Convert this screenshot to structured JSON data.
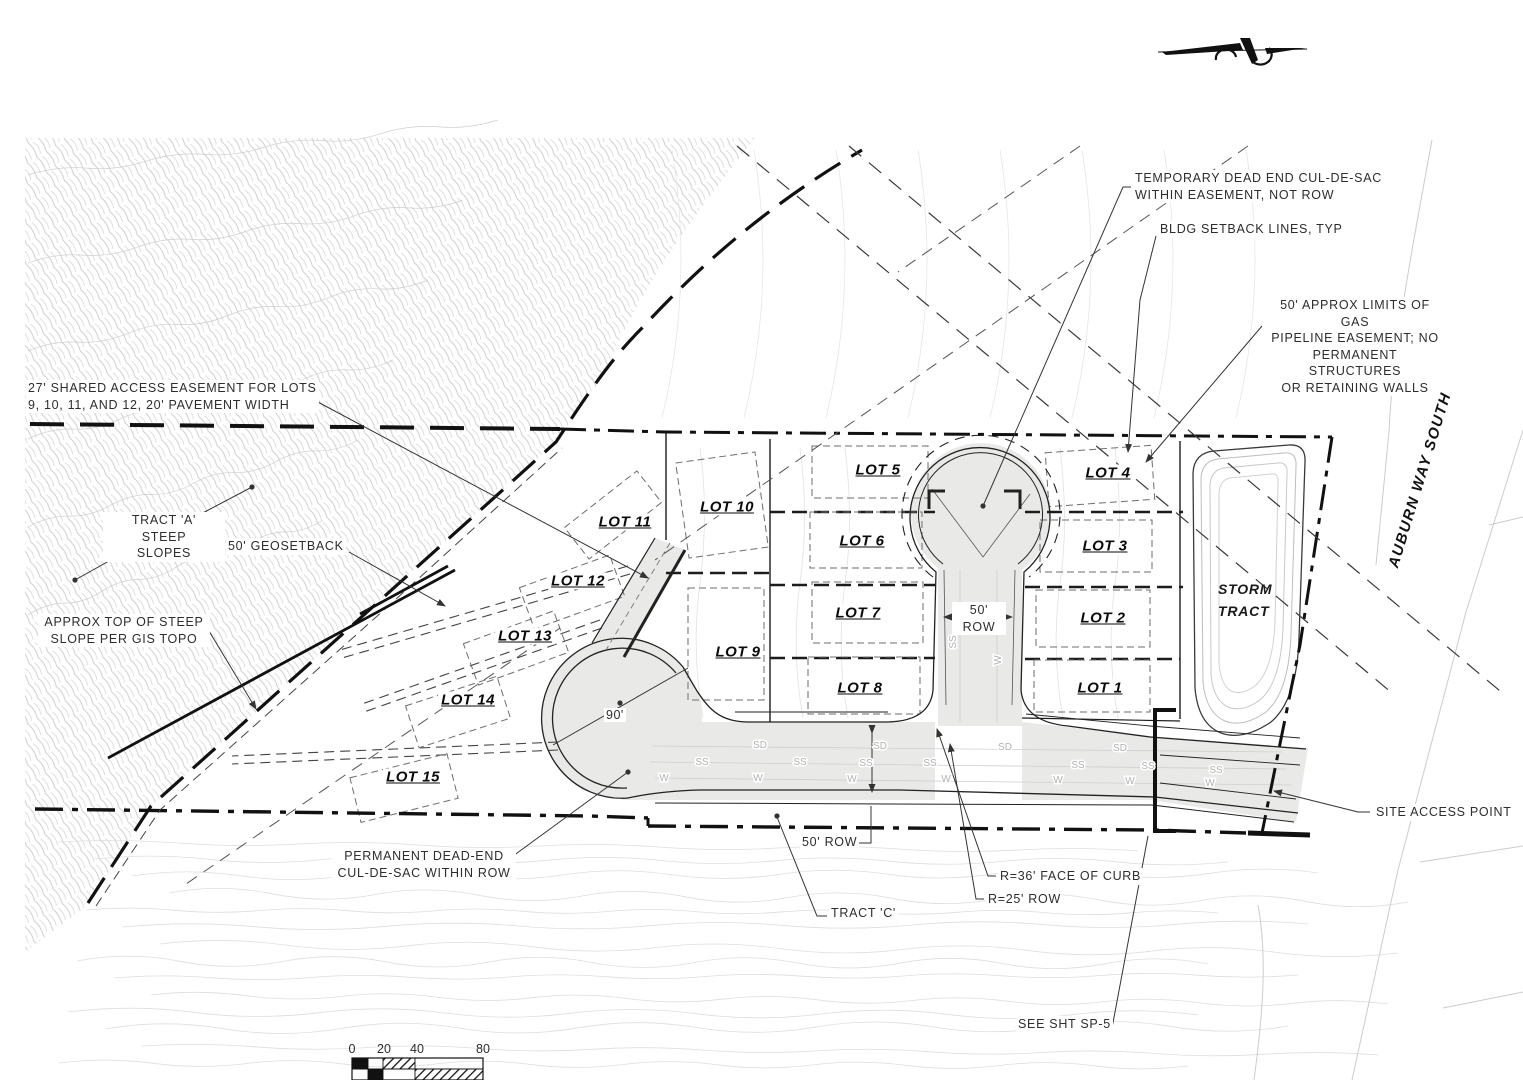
{
  "drawing": {
    "annotations": {
      "temp_culdesac": "TEMPORARY DEAD END CUL-DE-SAC\nWITHIN EASEMENT, NOT ROW",
      "bldg_setback": "BLDG SETBACK LINES, TYP",
      "gas_easement": "50' APPROX LIMITS OF GAS\nPIPELINE EASEMENT; NO\nPERMANENT STRUCTURES\nOR RETAINING WALLS",
      "shared_access": "27' SHARED ACCESS EASEMENT FOR LOTS\n9, 10, 11, AND 12, 20' PAVEMENT WIDTH",
      "tract_a": "TRACT 'A'\nSTEEP\nSLOPES",
      "geosetback": "50' GEOSETBACK",
      "approx_top": "APPROX TOP OF STEEP\nSLOPE PER GIS TOPO",
      "perm_culdesac": "PERMANENT DEAD-END\nCUL-DE-SAC WITHIN ROW",
      "tract_c": "TRACT 'C'",
      "row50_street": "50'\nROW",
      "row50_south": "50' ROW",
      "r36_curb": "R=36' FACE OF CURB",
      "r25_row": "R=25' ROW",
      "site_access": "SITE ACCESS POINT",
      "see_sheet": "SEE SHT SP-5",
      "dim_90": "90'",
      "storm_tract": "STORM\nTRACT",
      "auburn_way": "AUBURN WAY SOUTH"
    },
    "lots": [
      "LOT 1",
      "LOT 2",
      "LOT 3",
      "LOT 4",
      "LOT 5",
      "LOT 6",
      "LOT 7",
      "LOT 8",
      "LOT 9",
      "LOT 10",
      "LOT 11",
      "LOT 12",
      "LOT 13",
      "LOT 14",
      "LOT 15"
    ],
    "utilities": {
      "sd": "SD",
      "ss": "SS",
      "w": "W"
    },
    "scale_bar": {
      "labels": [
        "0",
        "20",
        "40",
        "80"
      ]
    },
    "colors": {
      "ink": "#1c1c1c",
      "contour": "#d8d8d8",
      "road_fill": "#e9e9e8"
    }
  }
}
